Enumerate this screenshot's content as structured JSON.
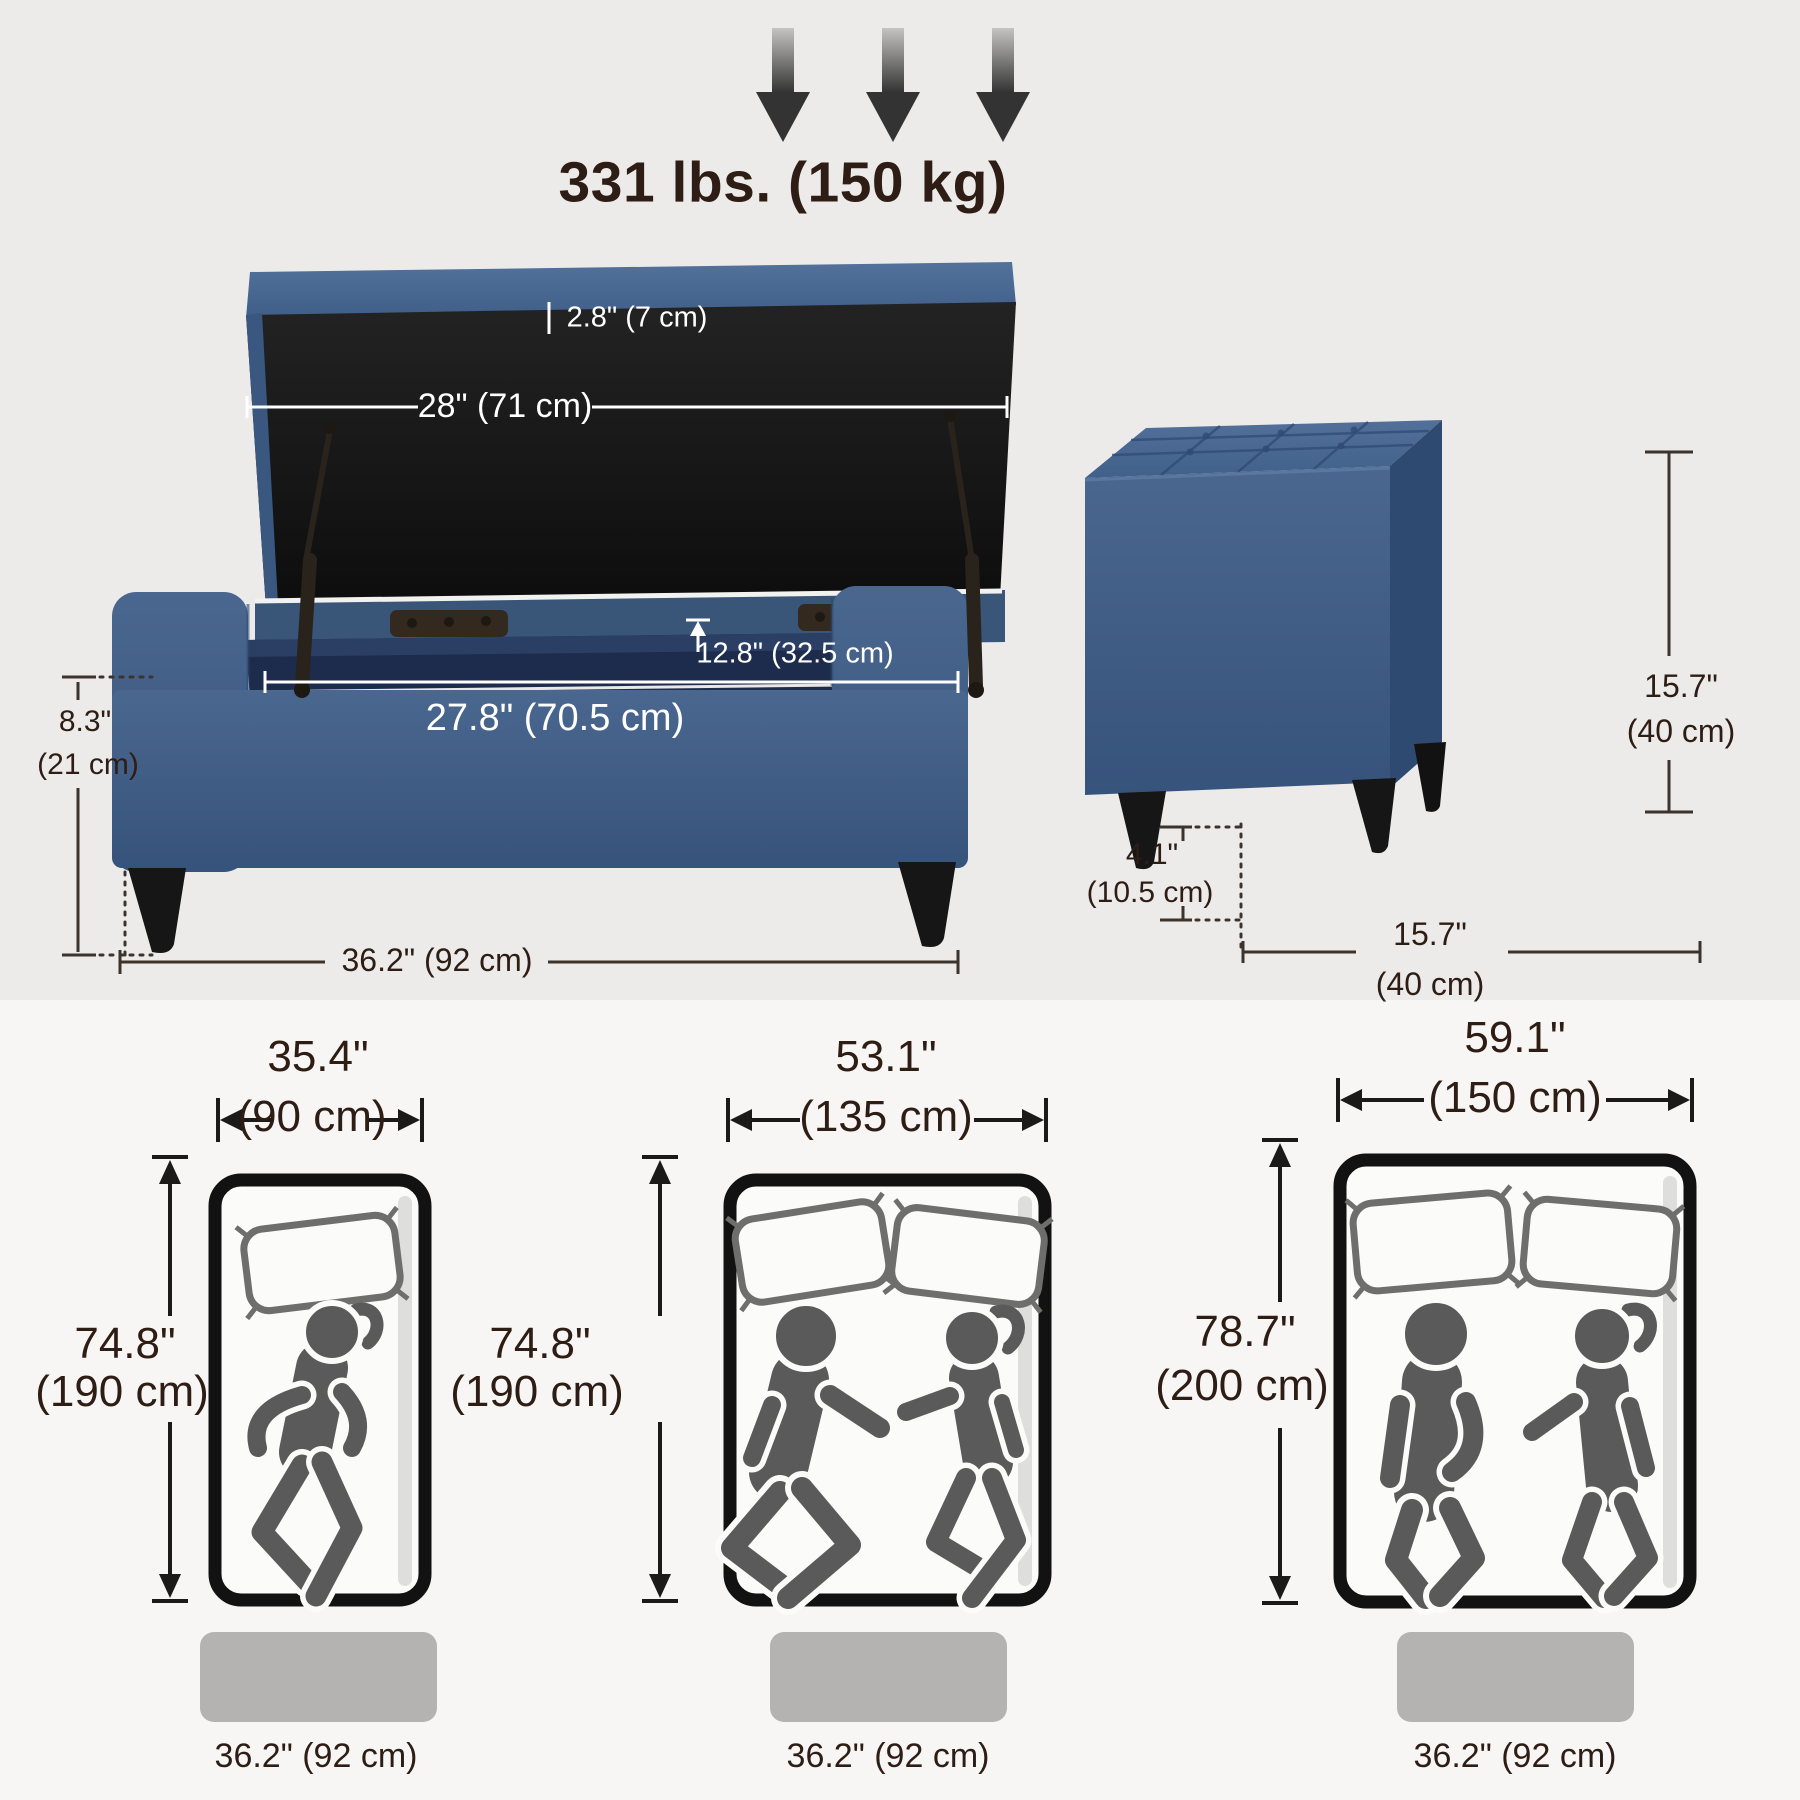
{
  "header": {
    "max_load": "331 lbs. (150 kg)"
  },
  "ottoman_front": {
    "lid_thickness": "2.8\" (7 cm)",
    "lid_width": "28\" (71 cm)",
    "opening_depth": "12.8\" (32.5 cm)",
    "interior_width": "27.8\" (70.5 cm)",
    "seat_height_in": "8.3\"",
    "seat_height_cm": "(21 cm)",
    "overall_width": "36.2\" (92 cm)"
  },
  "ottoman_side": {
    "height_in": "15.7\"",
    "height_cm": "(40 cm)",
    "leg_height_in": "4.1\"",
    "leg_height_cm": "(10.5 cm)",
    "depth_in": "15.7\"",
    "depth_cm": "(40 cm)"
  },
  "mattresses": [
    {
      "width_in": "35.4\"",
      "width_cm": "(90 cm)",
      "length_in": "74.8\"",
      "length_cm": "(190 cm)",
      "base_width": "36.2\" (92 cm)",
      "sleepers": 1
    },
    {
      "width_in": "53.1\"",
      "width_cm": "(135 cm)",
      "length_in": "74.8\"",
      "length_cm": "(190 cm)",
      "base_width": "36.2\" (92 cm)",
      "sleepers": 2
    },
    {
      "width_in": "59.1\"",
      "width_cm": "(150 cm)",
      "length_in": "78.7\"",
      "length_cm": "(200 cm)",
      "base_width": "36.2\" (92 cm)",
      "sleepers": 2
    }
  ],
  "colors": {
    "fabric_blue": "#3E5C84",
    "fabric_blue_light": "#4C6A93",
    "interior_navy": "#1D2B4C",
    "annotation_dark": "#2E1D14",
    "annotation_white": "#FFFFFF",
    "figure_gray": "#5A5A5A",
    "base_gray": "#B4B3B1"
  }
}
